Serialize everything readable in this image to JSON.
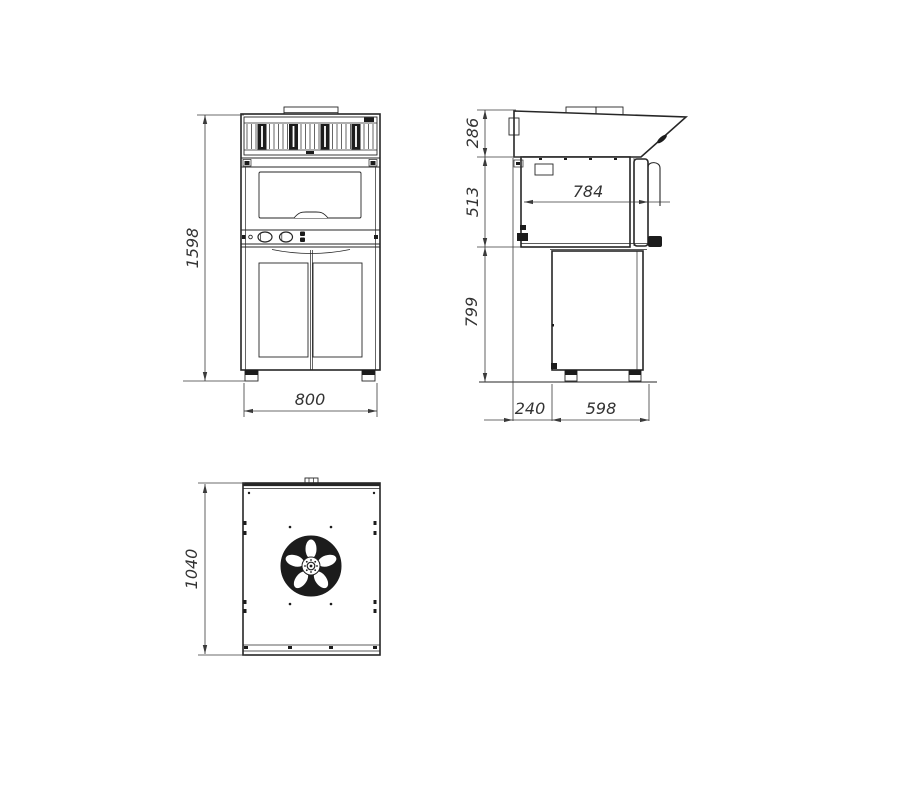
{
  "drawing_type": "technical-drawing-oven-three-views",
  "views": {
    "front": {
      "title": "front-view",
      "dimensions": {
        "height": "1598",
        "width": "800"
      }
    },
    "side": {
      "title": "side-view",
      "dimensions": {
        "hood_height": "286",
        "oven_height": "513",
        "base_height": "799",
        "oven_depth": "784",
        "back_offset": "240",
        "base_depth": "598"
      }
    },
    "top": {
      "title": "top-view",
      "dimensions": {
        "depth": "1040"
      }
    }
  },
  "colors": {
    "line": "#262626",
    "dimension": "#3a3a3a",
    "text": "#333333",
    "dark_fill": "#1c1c1c",
    "background": "#ffffff"
  }
}
